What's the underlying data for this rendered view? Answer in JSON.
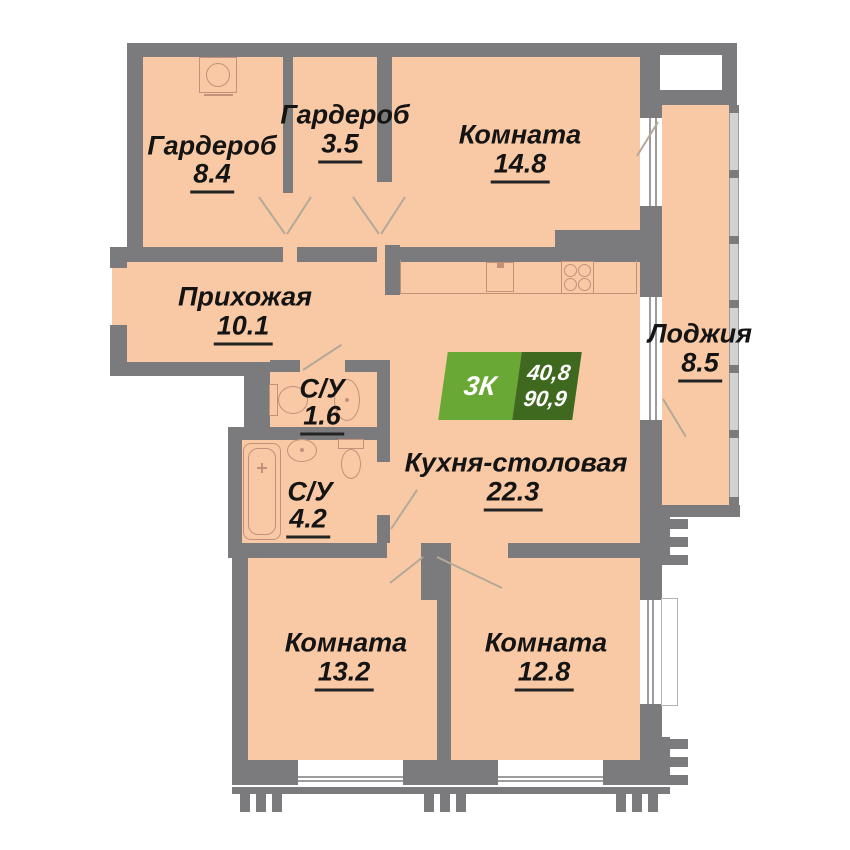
{
  "plan": {
    "type": "apartment-floor-plan",
    "badge": {
      "rooms_label": "3К",
      "area_living": "40,8",
      "area_total": "90,9"
    },
    "rooms": [
      {
        "id": "garderob-1",
        "name": "Гардероб",
        "area": "8.4"
      },
      {
        "id": "garderob-2",
        "name": "Гардероб",
        "area": "3.5"
      },
      {
        "id": "komnata-1",
        "name": "Комната",
        "area": "14.8"
      },
      {
        "id": "prihozhaya",
        "name": "Прихожая",
        "area": "10.1"
      },
      {
        "id": "su-1",
        "name": "С/У",
        "area": "1.6"
      },
      {
        "id": "kuhnya",
        "name": "Кухня-столовая",
        "area": "22.3"
      },
      {
        "id": "lodzhiya",
        "name": "Лоджия",
        "area": "8.5"
      },
      {
        "id": "su-2",
        "name": "С/У",
        "area": "4.2"
      },
      {
        "id": "komnata-2",
        "name": "Комната",
        "area": "13.2"
      },
      {
        "id": "komnata-3",
        "name": "Комната",
        "area": "12.8"
      }
    ],
    "fixtures": [
      "washing-machine",
      "kitchen-sink",
      "stove",
      "toilet",
      "bathroom-sink",
      "bathtub",
      "toilet",
      "bathroom-sink"
    ],
    "colors": {
      "wall": "#7b7b7d",
      "floor": "#f8c9a4",
      "fixture_outline": "#c3917a",
      "badge_light_green": "#6aa835",
      "badge_dark_green": "#3f691e",
      "badge_text": "#ffffff",
      "label_text": "#141414"
    }
  }
}
